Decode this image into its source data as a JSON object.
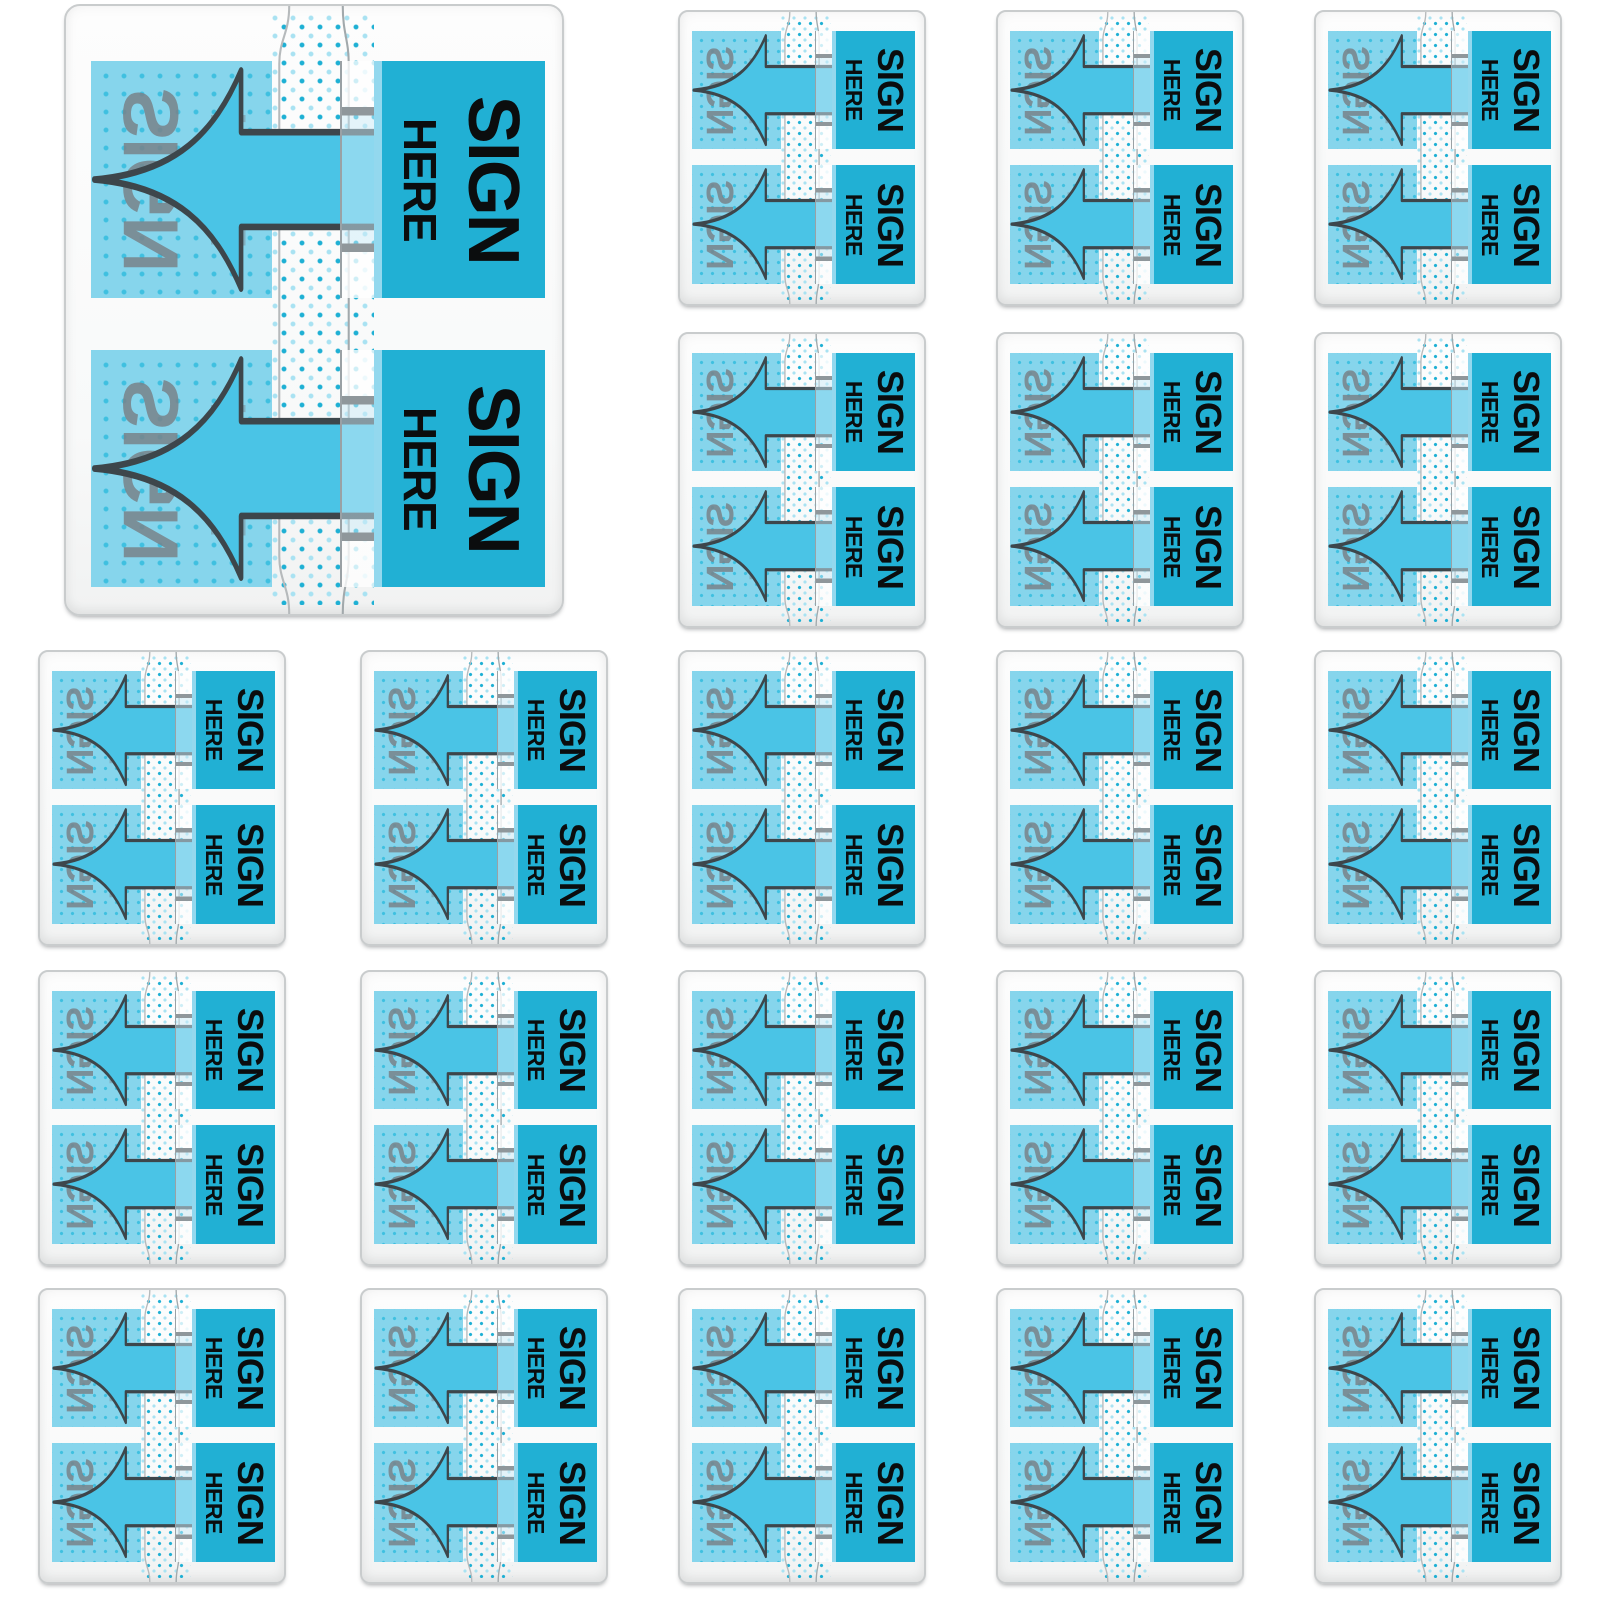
{
  "canvas": {
    "width": 1600,
    "height": 1600,
    "background": "#ffffff"
  },
  "product": {
    "name": "sign-here-flag-dispenser-collage",
    "dispenser_count": 22,
    "flags_per_dispenser": 2
  },
  "labels": {
    "tab_line1": "SIGN",
    "tab_line2": "HERE",
    "ghost_line1": "SIGN",
    "ghost_line2": "HERE"
  },
  "colors": {
    "tab_teal": "#21b0d4",
    "arrow_fill": "#4ac4e6",
    "arrow_outline": "#3d464b",
    "flag_translucent": "#86d5ec",
    "dot_on_blue": "#3fc0e0",
    "dot_dark": "#1fb0d4",
    "dot_light": "#a9e2f2",
    "ghost_gray": "#79838a",
    "slot_line": "#8f979b",
    "case_border": "#c9cccd"
  },
  "dispensers": [
    {
      "id": 1,
      "size": "lg",
      "x": 64,
      "y": 4,
      "w": 500,
      "h": 612
    },
    {
      "id": 2,
      "size": "sm",
      "x": 678,
      "y": 10,
      "w": 248,
      "h": 296
    },
    {
      "id": 3,
      "size": "sm",
      "x": 996,
      "y": 10,
      "w": 248,
      "h": 296
    },
    {
      "id": 4,
      "size": "sm",
      "x": 1314,
      "y": 10,
      "w": 248,
      "h": 296
    },
    {
      "id": 5,
      "size": "sm",
      "x": 678,
      "y": 332,
      "w": 248,
      "h": 296
    },
    {
      "id": 6,
      "size": "sm",
      "x": 996,
      "y": 332,
      "w": 248,
      "h": 296
    },
    {
      "id": 7,
      "size": "sm",
      "x": 1314,
      "y": 332,
      "w": 248,
      "h": 296
    },
    {
      "id": 8,
      "size": "sm",
      "x": 38,
      "y": 650,
      "w": 248,
      "h": 296
    },
    {
      "id": 9,
      "size": "sm",
      "x": 360,
      "y": 650,
      "w": 248,
      "h": 296
    },
    {
      "id": 10,
      "size": "sm",
      "x": 678,
      "y": 650,
      "w": 248,
      "h": 296
    },
    {
      "id": 11,
      "size": "sm",
      "x": 996,
      "y": 650,
      "w": 248,
      "h": 296
    },
    {
      "id": 12,
      "size": "sm",
      "x": 1314,
      "y": 650,
      "w": 248,
      "h": 296
    },
    {
      "id": 13,
      "size": "sm",
      "x": 38,
      "y": 970,
      "w": 248,
      "h": 296
    },
    {
      "id": 14,
      "size": "sm",
      "x": 360,
      "y": 970,
      "w": 248,
      "h": 296
    },
    {
      "id": 15,
      "size": "sm",
      "x": 678,
      "y": 970,
      "w": 248,
      "h": 296
    },
    {
      "id": 16,
      "size": "sm",
      "x": 996,
      "y": 970,
      "w": 248,
      "h": 296
    },
    {
      "id": 17,
      "size": "sm",
      "x": 1314,
      "y": 970,
      "w": 248,
      "h": 296
    },
    {
      "id": 18,
      "size": "sm",
      "x": 38,
      "y": 1288,
      "w": 248,
      "h": 296
    },
    {
      "id": 19,
      "size": "sm",
      "x": 360,
      "y": 1288,
      "w": 248,
      "h": 296
    },
    {
      "id": 20,
      "size": "sm",
      "x": 678,
      "y": 1288,
      "w": 248,
      "h": 296
    },
    {
      "id": 21,
      "size": "sm",
      "x": 996,
      "y": 1288,
      "w": 248,
      "h": 296
    },
    {
      "id": 22,
      "size": "sm",
      "x": 1314,
      "y": 1288,
      "w": 248,
      "h": 296
    }
  ]
}
